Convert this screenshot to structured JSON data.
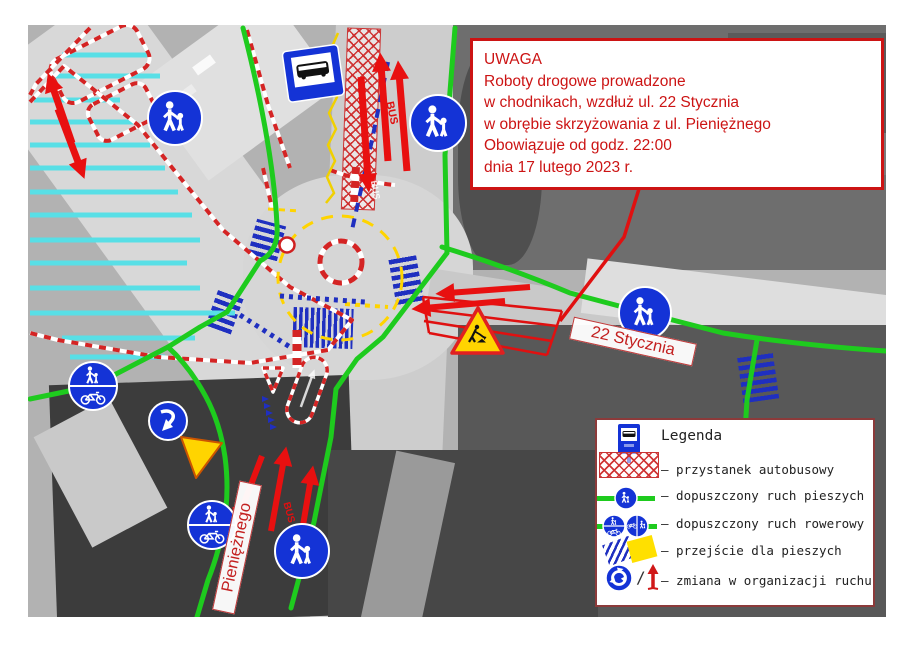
{
  "notice": {
    "lines": [
      "UWAGA",
      "Roboty drogowe prowadzone",
      "w chodnikach, wzdłuż ul. 22 Stycznia",
      "w obrębie skrzyżowania z ul. Pieniężnego",
      "Obowiązuje od godz. 22:00",
      "dnia 17 lutego 2023 r."
    ]
  },
  "legend": {
    "title": "Legenda",
    "separator": "/",
    "items": [
      {
        "icon": "bus-stop-sign-and-crosshatch",
        "label": "– przystanek autobusowy"
      },
      {
        "icon": "green-line-pedestrian-sign",
        "label": "– dopuszczony ruch pieszych"
      },
      {
        "icon": "green-line-bicycle-signs",
        "label": "– dopuszczony ruch rowerowy"
      },
      {
        "icon": "blue-stripes-yellow-patch",
        "label": "– przejście dla pieszych"
      },
      {
        "icon": "roundabout-sign-red-arrow",
        "label": "– zmiana w organizacji ruchu"
      }
    ]
  },
  "street_labels": {
    "main": "22 Stycznia",
    "cross": "Pieniężnego"
  },
  "road_markings": {
    "bus_lane_top": "BUS",
    "bus_lane_bottom": "BUS",
    "bus_paint": "BUS"
  },
  "colors": {
    "notice_red": "#cc1414",
    "route_green": "#1ecb1e",
    "sign_blue": "#1433d6",
    "crossing_blue": "#1f2fc0",
    "stripe_cyan": "#58dfe6",
    "work_yellow": "#ffd400",
    "zone_red": "#d42424"
  }
}
